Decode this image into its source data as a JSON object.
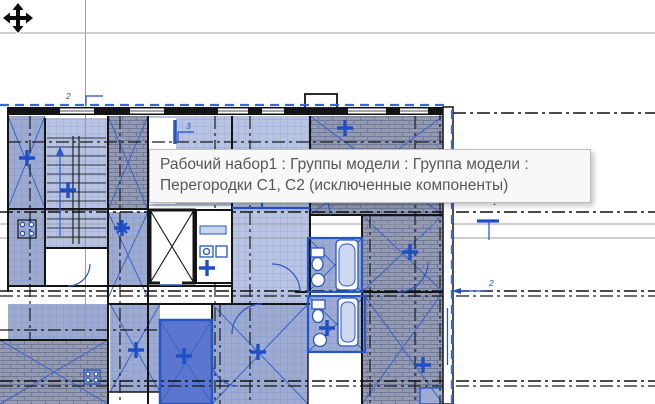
{
  "tooltip": {
    "line1": "Рабочий набор1 : Группы модели : Группа модели :",
    "line2": "Перегородки С1, С2 (исключенные компоненты)"
  },
  "labels": {
    "grid_tag_top": "2",
    "wall_tag": "3",
    "dim_tag_right": "2",
    "small_mark": "1"
  },
  "cursor": {
    "type": "move"
  },
  "colors": {
    "selection_blue": "#2456c6",
    "span_mark_blue": "#1e4fc4",
    "room_fill_light": "#b9c4e3",
    "room_fill_medium": "#9dabd1",
    "room_fill_dark": "#939ab2",
    "room_fill_highlight": "#5b76cf",
    "crop_boundary_blue": "#3767d6",
    "wall_black": "#141414",
    "guide_gray": "#9e9e9e",
    "tooltip_bg": "#f8f8f8",
    "tooltip_border": "#bdbdbd",
    "tooltip_text": "#575757"
  }
}
